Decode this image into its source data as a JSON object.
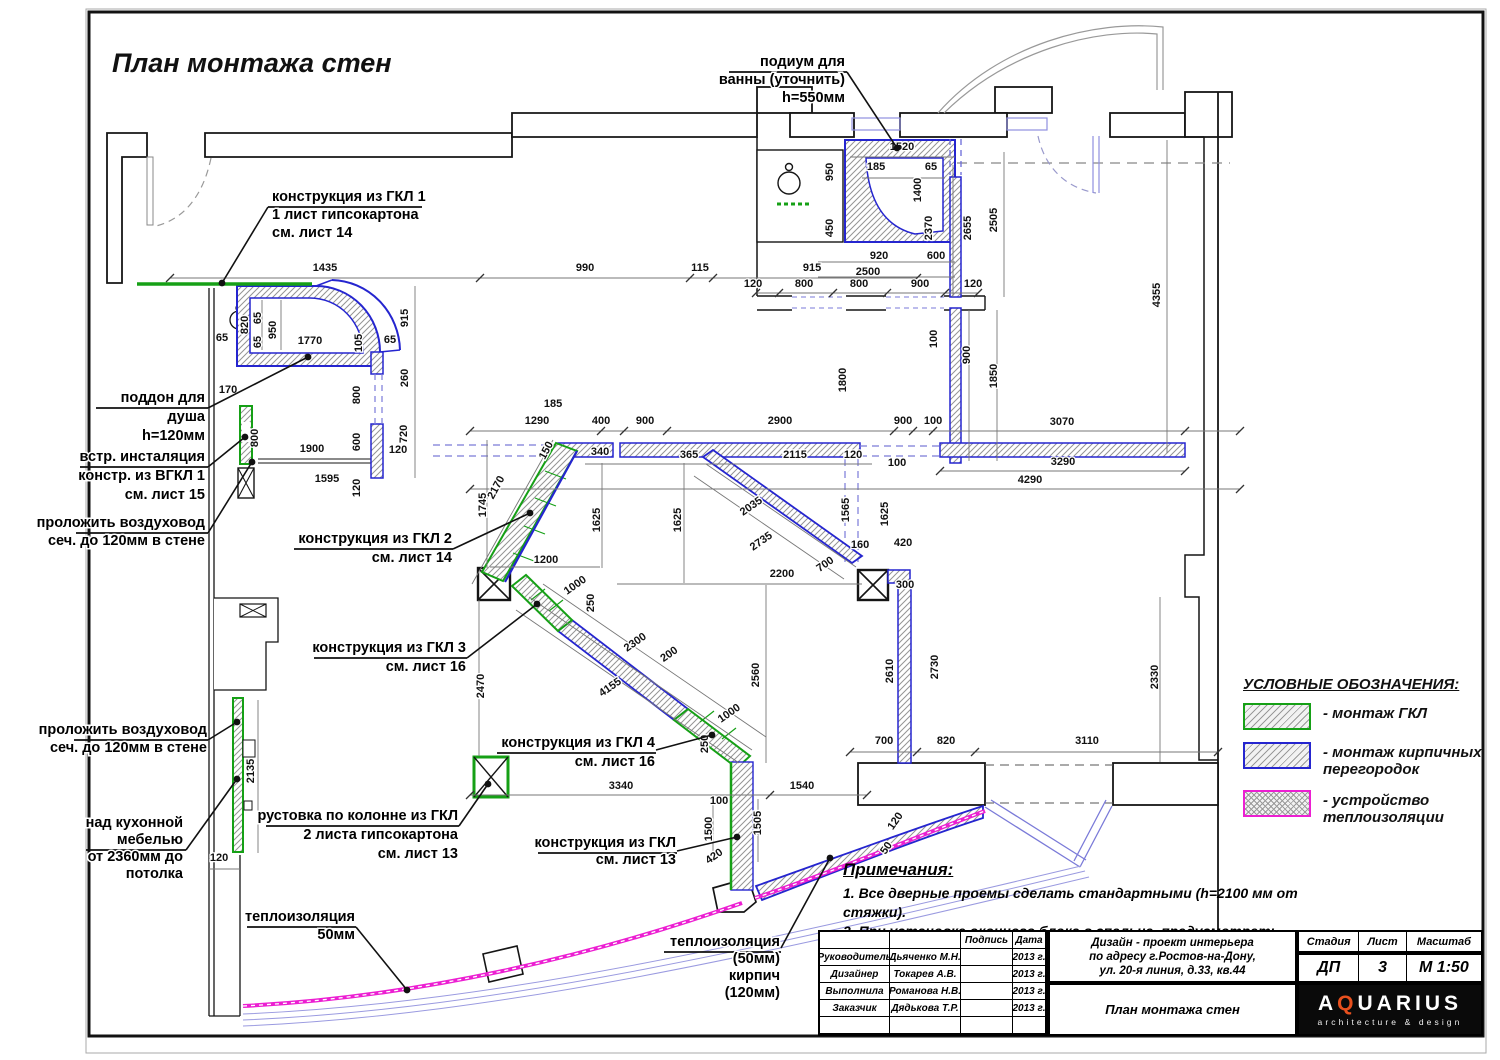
{
  "title": "План монтажа стен",
  "legend": {
    "title": "УСЛОВНЫЕ ОБОЗНАЧЕНИЯ:",
    "items": [
      {
        "label": "- монтаж ГКЛ",
        "color": "#16a016",
        "pattern": "hatch"
      },
      {
        "label": "- монтаж кирпичных перегородок",
        "color": "#2525cf",
        "pattern": "hatch"
      },
      {
        "label": "- устройство теплоизоляции",
        "color": "#ec1fd2",
        "pattern": "crosshatch"
      }
    ]
  },
  "notes": {
    "title": "Примечания:",
    "items": [
      "1. Все дверные проемы сделать стандартными (h=2100 мм от стяжки).",
      "2. При установке оконного блока в спальне, предусмотреть фрамугу"
    ]
  },
  "drawing": {
    "callouts": [
      {
        "x": 272,
        "y": 201,
        "align": "l",
        "lh": 18,
        "lines": [
          "конструкция из ГКЛ 1",
          "1 лист гипсокартона",
          "см. лист 14"
        ],
        "ul": [
          268,
          422,
          207
        ],
        "leader": [
          [
            268,
            207
          ],
          [
            222,
            283
          ]
        ]
      },
      {
        "x": 845,
        "y": 66,
        "align": "r",
        "lh": 18,
        "lines": [
          "подиум для",
          "ванны (уточнить)",
          "h=550мм"
        ],
        "ul": [
          729,
          847,
          72
        ],
        "leader": [
          [
            847,
            72
          ],
          [
            897,
            148
          ]
        ]
      },
      {
        "x": 205,
        "y": 402,
        "align": "r",
        "lh": 19,
        "lines": [
          "поддон для",
          "душа",
          "h=120мм"
        ],
        "ul": [
          96,
          208,
          408
        ],
        "leader": [
          [
            208,
            408
          ],
          [
            308,
            357
          ]
        ]
      },
      {
        "x": 205,
        "y": 461,
        "align": "r",
        "lh": 19,
        "lines": [
          "встр. инсталяция",
          "констр. из ВГКЛ 1",
          "см. лист 15"
        ],
        "ul": [
          80,
          208,
          467
        ],
        "leader": [
          [
            208,
            467
          ],
          [
            245,
            437
          ]
        ]
      },
      {
        "x": 205,
        "y": 527,
        "align": "r",
        "lh": 18,
        "lines": [
          "проложить воздуховод",
          "сеч. до 120мм в стене"
        ],
        "ul": [
          76,
          208,
          533
        ],
        "leader": [
          [
            208,
            533
          ],
          [
            252,
            462
          ]
        ]
      },
      {
        "x": 452,
        "y": 543,
        "align": "r",
        "lh": 19,
        "lines": [
          "конструкция из ГКЛ 2",
          "см. лист 14"
        ],
        "ul": [
          294,
          453,
          549
        ],
        "leader": [
          [
            453,
            549
          ],
          [
            530,
            513
          ]
        ]
      },
      {
        "x": 466,
        "y": 652,
        "align": "r",
        "lh": 19,
        "lines": [
          "конструкция из ГКЛ 3",
          "см. лист 16"
        ],
        "ul": [
          314,
          467,
          658
        ],
        "leader": [
          [
            467,
            658
          ],
          [
            537,
            604
          ]
        ]
      },
      {
        "x": 655,
        "y": 747,
        "align": "r",
        "lh": 19,
        "lines": [
          "конструкция из ГКЛ 4",
          "см. лист 16"
        ],
        "ul": [
          497,
          656,
          753
        ],
        "leader": [
          [
            656,
            750
          ],
          [
            712,
            735
          ]
        ]
      },
      {
        "x": 458,
        "y": 820,
        "align": "r",
        "lh": 19,
        "lines": [
          "рустовка по колонне из ГКЛ",
          "2 листа гипсокартона",
          "см. лист 13"
        ],
        "ul": [
          266,
          459,
          826
        ],
        "leader": [
          [
            459,
            826
          ],
          [
            488,
            784
          ]
        ]
      },
      {
        "x": 676,
        "y": 847,
        "align": "r",
        "lh": 17,
        "lines": [
          "конструкция из ГКЛ",
          "см. лист 13"
        ],
        "ul": [
          538,
          677,
          853
        ],
        "leader": [
          [
            677,
            851
          ],
          [
            737,
            837
          ]
        ]
      },
      {
        "x": 207,
        "y": 734,
        "align": "r",
        "lh": 18,
        "lines": [
          "проложить воздуховод",
          "сеч. до 120мм в стене"
        ],
        "ul": [
          74,
          208,
          740
        ],
        "leader": [
          [
            208,
            740
          ],
          [
            237,
            722
          ]
        ]
      },
      {
        "x": 183,
        "y": 827,
        "align": "r",
        "lh": 17,
        "lines": [
          "над кухонной",
          "мебелью",
          "от 2360мм до",
          "потолка"
        ],
        "ul": [
          86,
          186,
          850
        ],
        "leader": [
          [
            186,
            850
          ],
          [
            237,
            779
          ]
        ]
      },
      {
        "x": 355,
        "y": 921,
        "align": "r",
        "lh": 18,
        "lines": [
          "теплоизоляция",
          "50мм"
        ],
        "ul": [
          247,
          356,
          927
        ],
        "leader": [
          [
            356,
            927
          ],
          [
            407,
            990
          ]
        ]
      },
      {
        "x": 780,
        "y": 946,
        "align": "r",
        "lh": 17,
        "lines": [
          "теплоизоляция",
          "(50мм)",
          "кирпич",
          "(120мм)"
        ],
        "ul": [
          664,
          781,
          952
        ],
        "leader": [
          [
            781,
            948
          ],
          [
            830,
            858
          ]
        ]
      }
    ],
    "dimensions": [
      [
        325,
        271,
        0,
        "1435"
      ],
      [
        585,
        271,
        0,
        "990"
      ],
      [
        700,
        271,
        0,
        "115"
      ],
      [
        812,
        271,
        0,
        "915"
      ],
      [
        902,
        150,
        0,
        "1520"
      ],
      [
        876,
        170,
        0,
        "185"
      ],
      [
        931,
        170,
        0,
        "65"
      ],
      [
        833,
        172,
        -90,
        "950"
      ],
      [
        921,
        190,
        -90,
        "1400"
      ],
      [
        833,
        228,
        -90,
        "450"
      ],
      [
        932,
        228,
        -90,
        "2370"
      ],
      [
        879,
        259,
        0,
        "920"
      ],
      [
        936,
        259,
        0,
        "600"
      ],
      [
        868,
        275,
        0,
        "2500"
      ],
      [
        753,
        287,
        0,
        "120"
      ],
      [
        804,
        287,
        0,
        "800"
      ],
      [
        859,
        287,
        0,
        "800"
      ],
      [
        920,
        287,
        0,
        "900"
      ],
      [
        973,
        287,
        0,
        "120"
      ],
      [
        971,
        228,
        -90,
        "2655"
      ],
      [
        997,
        220,
        -90,
        "2505"
      ],
      [
        1160,
        295,
        -90,
        "4355"
      ],
      [
        937,
        339,
        -90,
        "100"
      ],
      [
        970,
        355,
        -90,
        "900"
      ],
      [
        997,
        376,
        -90,
        "1850"
      ],
      [
        846,
        380,
        -90,
        "1800"
      ],
      [
        222,
        341,
        0,
        "65"
      ],
      [
        248,
        325,
        -90,
        "820"
      ],
      [
        261,
        318,
        -90,
        "65"
      ],
      [
        261,
        342,
        -90,
        "65"
      ],
      [
        276,
        330,
        -90,
        "950"
      ],
      [
        310,
        344,
        0,
        "1770"
      ],
      [
        362,
        343,
        -90,
        "105"
      ],
      [
        390,
        343,
        0,
        "65"
      ],
      [
        408,
        318,
        -90,
        "915"
      ],
      [
        408,
        378,
        -90,
        "260"
      ],
      [
        360,
        395,
        -90,
        "800"
      ],
      [
        228,
        393,
        0,
        "170"
      ],
      [
        258,
        438,
        -90,
        "800"
      ],
      [
        360,
        442,
        -90,
        "600"
      ],
      [
        407,
        434,
        -90,
        "720"
      ],
      [
        398,
        453,
        0,
        "120"
      ],
      [
        312,
        452,
        0,
        "1900"
      ],
      [
        327,
        482,
        0,
        "1595"
      ],
      [
        360,
        488,
        -90,
        "120"
      ],
      [
        553,
        407,
        0,
        "185"
      ],
      [
        537,
        424,
        0,
        "1290"
      ],
      [
        601,
        424,
        0,
        "400"
      ],
      [
        645,
        424,
        0,
        "900"
      ],
      [
        780,
        424,
        0,
        "2900"
      ],
      [
        903,
        424,
        0,
        "900"
      ],
      [
        933,
        424,
        0,
        "100"
      ],
      [
        1062,
        425,
        0,
        "3070"
      ],
      [
        600,
        455,
        0,
        "340"
      ],
      [
        689,
        458,
        0,
        "365"
      ],
      [
        795,
        458,
        0,
        "2115"
      ],
      [
        853,
        458,
        0,
        "120"
      ],
      [
        897,
        466,
        0,
        "100"
      ],
      [
        1063,
        465,
        0,
        "3290"
      ],
      [
        1030,
        483,
        0,
        "4290"
      ],
      [
        549,
        452,
        -62,
        "150"
      ],
      [
        499,
        489,
        -62,
        "2170"
      ],
      [
        486,
        505,
        -90,
        "1745"
      ],
      [
        600,
        520,
        -90,
        "1625"
      ],
      [
        681,
        520,
        -90,
        "1625"
      ],
      [
        753,
        509,
        -35,
        "2035"
      ],
      [
        763,
        544,
        -35,
        "2735"
      ],
      [
        849,
        510,
        -90,
        "1565"
      ],
      [
        888,
        514,
        -90,
        "1625"
      ],
      [
        860,
        548,
        0,
        "160"
      ],
      [
        903,
        546,
        0,
        "420"
      ],
      [
        546,
        563,
        0,
        "1200"
      ],
      [
        577,
        588,
        -35,
        "1000"
      ],
      [
        827,
        567,
        -35,
        "700"
      ],
      [
        782,
        577,
        0,
        "2200"
      ],
      [
        905,
        588,
        0,
        "300"
      ],
      [
        594,
        603,
        -90,
        "250"
      ],
      [
        759,
        675,
        -90,
        "2560"
      ],
      [
        637,
        645,
        -35,
        "2300"
      ],
      [
        671,
        657,
        -35,
        "200"
      ],
      [
        612,
        690,
        -35,
        "4155"
      ],
      [
        731,
        716,
        -35,
        "1000"
      ],
      [
        708,
        744,
        -90,
        "250"
      ],
      [
        893,
        671,
        -90,
        "2610"
      ],
      [
        938,
        667,
        -90,
        "2730"
      ],
      [
        484,
        686,
        -90,
        "2470"
      ],
      [
        1158,
        677,
        -90,
        "2330"
      ],
      [
        254,
        771,
        -90,
        "2135"
      ],
      [
        219,
        861,
        0,
        "120"
      ],
      [
        884,
        744,
        0,
        "700"
      ],
      [
        946,
        744,
        0,
        "820"
      ],
      [
        1087,
        744,
        0,
        "3110"
      ],
      [
        621,
        789,
        0,
        "3340"
      ],
      [
        802,
        789,
        0,
        "1540"
      ],
      [
        719,
        804,
        0,
        "100"
      ],
      [
        712,
        829,
        -90,
        "1500"
      ],
      [
        761,
        823,
        -90,
        "1505"
      ],
      [
        716,
        859,
        -35,
        "420"
      ],
      [
        898,
        823,
        -55,
        "120"
      ],
      [
        889,
        850,
        -55,
        "50"
      ]
    ]
  },
  "titleblock": {
    "col_sign": "Подпись",
    "col_date": "Дата",
    "rows": [
      {
        "role": "Руководитель",
        "name": "Дьяченко М.Н.",
        "date": "2013 г."
      },
      {
        "role": "Дизайнер",
        "name": "Токарев А.В.",
        "date": "2013 г."
      },
      {
        "role": "Выполнила",
        "name": "Романова Н.В.",
        "date": "2013 г."
      },
      {
        "role": "Заказчик",
        "name": "Дядькова Т.Р.",
        "date": "2013 г."
      }
    ],
    "project_lines": [
      "Дизайн - проект интерьера",
      "по адресу г.Ростов-на-Дону,",
      "ул. 20-я линия, д.33, кв.44"
    ],
    "doc_title": "План монтажа стен",
    "stage_label": "Стадия",
    "stage": "ДП",
    "sheet_label": "Лист",
    "sheet": "3",
    "scale_label": "Масштаб",
    "scale": "М 1:50",
    "logo_a": "A",
    "logo_q": "Q",
    "logo_rest": "UARIUS",
    "logo_sub": "architecture & design",
    "accent_color": "#e8501e"
  }
}
